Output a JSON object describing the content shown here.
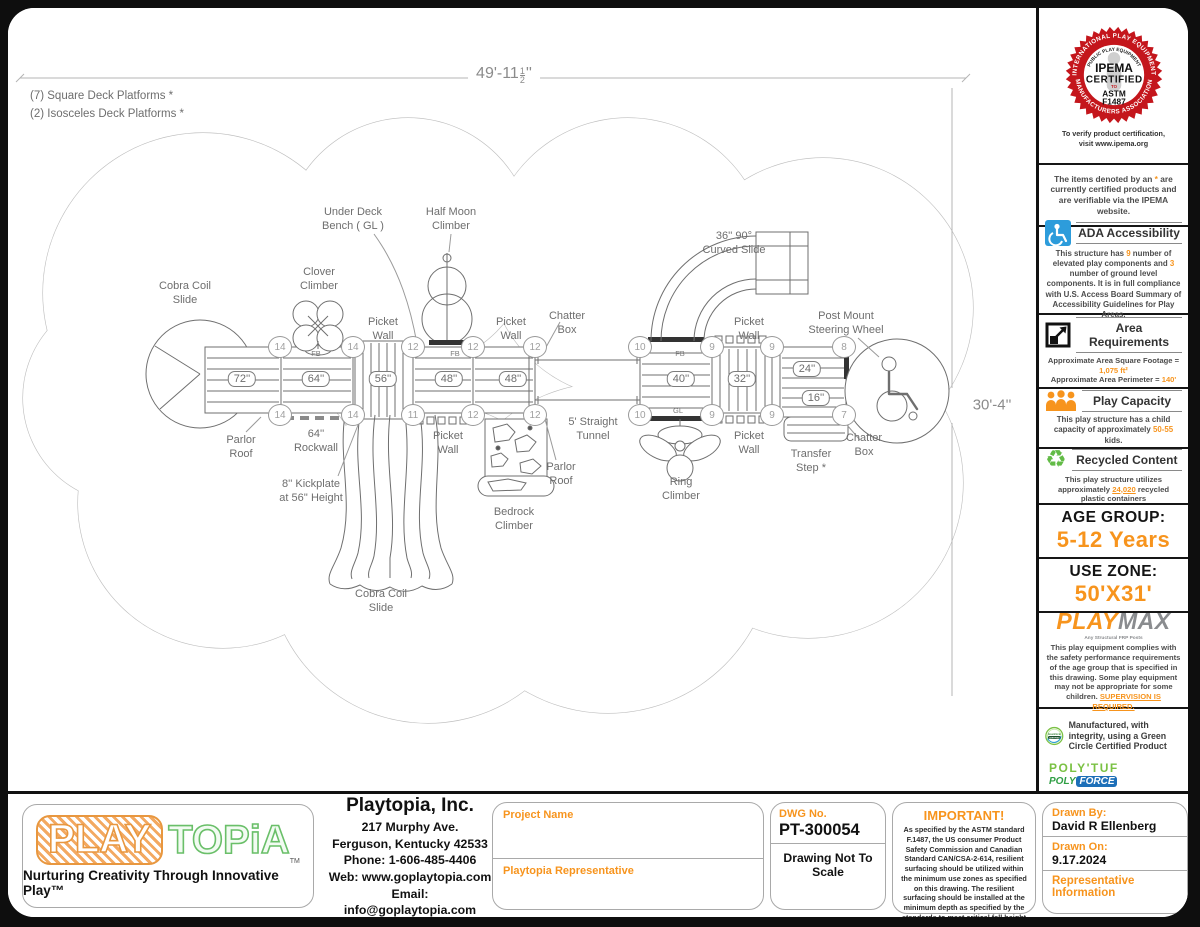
{
  "colors": {
    "accent": "#F7941D",
    "seal_red": "#C4161C",
    "ada_blue": "#2D9CDB",
    "green": "#62BB46",
    "gray": "#808285"
  },
  "drawing": {
    "notes": [
      "(7) Square Deck Platforms *",
      "(2) Isosceles Deck Platforms *"
    ],
    "dim_top": {
      "whole": "49'-11",
      "num": "1",
      "den": "2",
      "suffix": "''"
    },
    "dim_right": {
      "whole": "30'-4",
      "suffix": "''"
    },
    "labels": [
      {
        "t": "Cobra Coil\nSlide",
        "x": 177,
        "y": 272
      },
      {
        "t": "Clover\nClimber",
        "x": 311,
        "y": 258
      },
      {
        "t": "Under Deck\nBench ( GL )",
        "x": 345,
        "y": 198
      },
      {
        "t": "Half Moon\nClimber",
        "x": 443,
        "y": 198
      },
      {
        "t": "Picket\nWall",
        "x": 375,
        "y": 308
      },
      {
        "t": "Picket\nWall",
        "x": 503,
        "y": 308
      },
      {
        "t": "Chatter\nBox",
        "x": 559,
        "y": 302
      },
      {
        "t": "36'' 90°\nCurved Slide",
        "x": 726,
        "y": 222
      },
      {
        "t": "Picket\nWall",
        "x": 741,
        "y": 308
      },
      {
        "t": "Post Mount\nSteering Wheel",
        "x": 838,
        "y": 302
      },
      {
        "t": "Parlor\nRoof",
        "x": 233,
        "y": 426
      },
      {
        "t": "64''\nRockwall",
        "x": 308,
        "y": 420
      },
      {
        "t": "8'' Kickplate\nat 56'' Height",
        "x": 303,
        "y": 470
      },
      {
        "t": "Picket\nWall",
        "x": 440,
        "y": 422
      },
      {
        "t": "5' Straight\nTunnel",
        "x": 585,
        "y": 408
      },
      {
        "t": "Parlor\nRoof",
        "x": 553,
        "y": 453
      },
      {
        "t": "Bedrock\nClimber",
        "x": 506,
        "y": 498
      },
      {
        "t": "Ring\nClimber",
        "x": 673,
        "y": 468
      },
      {
        "t": "Picket\nWall",
        "x": 741,
        "y": 422
      },
      {
        "t": "Transfer\nStep *",
        "x": 803,
        "y": 440
      },
      {
        "t": "Chatter\nBox",
        "x": 856,
        "y": 424
      },
      {
        "t": "Cobra Coil\nSlide",
        "x": 373,
        "y": 580
      },
      {
        "t": "FB",
        "x": 308,
        "y": 341,
        "s": true
      },
      {
        "t": "FB",
        "x": 447,
        "y": 341,
        "s": true
      },
      {
        "t": "FB",
        "x": 672,
        "y": 341,
        "s": true
      },
      {
        "t": "GL",
        "x": 670,
        "y": 398,
        "s": true
      }
    ],
    "decks": [
      {
        "t": "72''",
        "x": 234,
        "y": 371
      },
      {
        "t": "64''",
        "x": 308,
        "y": 371
      },
      {
        "t": "56''",
        "x": 375,
        "y": 371
      },
      {
        "t": "48''",
        "x": 441,
        "y": 371
      },
      {
        "t": "48''",
        "x": 505,
        "y": 371
      },
      {
        "t": "40''",
        "x": 673,
        "y": 371
      },
      {
        "t": "32''",
        "x": 734,
        "y": 371
      },
      {
        "t": "24''",
        "x": 799,
        "y": 361
      },
      {
        "t": "16''",
        "x": 808,
        "y": 390
      }
    ],
    "markers": [
      {
        "n": "14",
        "x": 272,
        "y": 339
      },
      {
        "n": "14",
        "x": 345,
        "y": 339
      },
      {
        "n": "12",
        "x": 405,
        "y": 339
      },
      {
        "n": "12",
        "x": 465,
        "y": 339
      },
      {
        "n": "12",
        "x": 527,
        "y": 339
      },
      {
        "n": "10",
        "x": 632,
        "y": 339
      },
      {
        "n": "9",
        "x": 704,
        "y": 339
      },
      {
        "n": "9",
        "x": 764,
        "y": 339
      },
      {
        "n": "8",
        "x": 836,
        "y": 339
      },
      {
        "n": "14",
        "x": 272,
        "y": 407
      },
      {
        "n": "14",
        "x": 345,
        "y": 407
      },
      {
        "n": "11",
        "x": 405,
        "y": 407
      },
      {
        "n": "12",
        "x": 465,
        "y": 407
      },
      {
        "n": "12",
        "x": 527,
        "y": 407
      },
      {
        "n": "10",
        "x": 632,
        "y": 407
      },
      {
        "n": "9",
        "x": 704,
        "y": 407
      },
      {
        "n": "9",
        "x": 764,
        "y": 407
      },
      {
        "n": "7",
        "x": 836,
        "y": 407
      }
    ]
  },
  "sidebar": {
    "ipema": {
      "ring_top": "INTERNATIONAL PLAY EQUIPMENT",
      "ring_bottom": "MANUFACTURERS ASSOCIATION",
      "arc": "PUBLIC PLAY EQUIPMENT",
      "name": "IPEMA",
      "certified": "CERTIFIED",
      "to": "TO",
      "astm": "ASTM",
      "code": "F1487",
      "verify1": "To verify product certification,",
      "verify2": "visit www.ipema.org"
    },
    "denoted": {
      "p1": "The items denoted by an ",
      "sym": "*",
      "p2": " are currently certified products and are verifiable via the IPEMA website."
    },
    "ada": {
      "title": "ADA Accessibility",
      "p1": "This structure has ",
      "v1": "9",
      "p2": " number of elevated play components and ",
      "v2": "3",
      "p3": " number of ground level components. It is in full compliance with U.S. Access Board Summary of Accessibility Guidelines for Play Areas."
    },
    "area": {
      "title": "Area Requirements",
      "p1": "Approximate Area Square Footage = ",
      "v1": "1,075 ft²",
      "p2": "Approximate Area Perimeter = ",
      "v2": "140'"
    },
    "capacity": {
      "title": "Play Capacity",
      "p1": "This play structure has a child capacity of approximately ",
      "v1": "50-55",
      "p2": " kids."
    },
    "recycled": {
      "title": "Recycled Content",
      "p1": "This play structure utilizes approximately ",
      "v1": "24,020",
      "p2": " recycled plastic containers"
    },
    "age": {
      "label": "AGE GROUP:",
      "value": "5-12 Years"
    },
    "zone": {
      "label": "USE ZONE:",
      "value": "50'X31'"
    },
    "playmax": {
      "brand1": "PLAY",
      "brand2": "MAX",
      "tag": "Any Structural FRP Posts",
      "p1": "This play equipment complies with the safety performance requirements of the age group that is specified in this drawing. Some play equipment may not be appropriate for some children. ",
      "v1": "SUPERVISION IS REQUIRED."
    },
    "green": {
      "badge1": "GreenCircle",
      "badge2": "CERTIFIED",
      "text": "Manufactured, with integrity, using a Green Circle Certified Product",
      "brand1": "POLY'TUF",
      "brand2a": "POLY",
      "brand2b": "FORCE"
    }
  },
  "footer": {
    "logo": {
      "play": "PLAY",
      "topia": "TOPiA",
      "tm": "TM",
      "tagline": "Nurturing Creativity Through Innovative Play™"
    },
    "company": {
      "name": "Playtopia, Inc.",
      "line1": "217 Murphy Ave.",
      "line2": "Ferguson, Kentucky 42533",
      "line3": "Phone: 1-606-485-4406",
      "line4": "Web: www.goplaytopia.com",
      "line5": "Email: info@goplaytopia.com"
    },
    "project": {
      "label1": "Project Name",
      "label2": "Playtopia Representative"
    },
    "dwg": {
      "label": "DWG No.",
      "number": "PT-300054",
      "note": "Drawing Not To Scale"
    },
    "important": {
      "title": "IMPORTANT!",
      "body": "As specified by the ASTM standard F.1487, the US consumer Product Safety Commission and Canadian Standard CAN/CSA-2-614, resilient surfacing should be utilized within the minimum use zones as specified on this drawing. The resilient surfacing should be installed at the minimum depth as specified by the standards to meet critical fall height requirements."
    },
    "drawn": {
      "by_label": "Drawn By:",
      "by_value": "David R Ellenberg",
      "on_label": "Drawn On:",
      "on_value": "9.17.2024",
      "rep": "Representative Information"
    }
  }
}
